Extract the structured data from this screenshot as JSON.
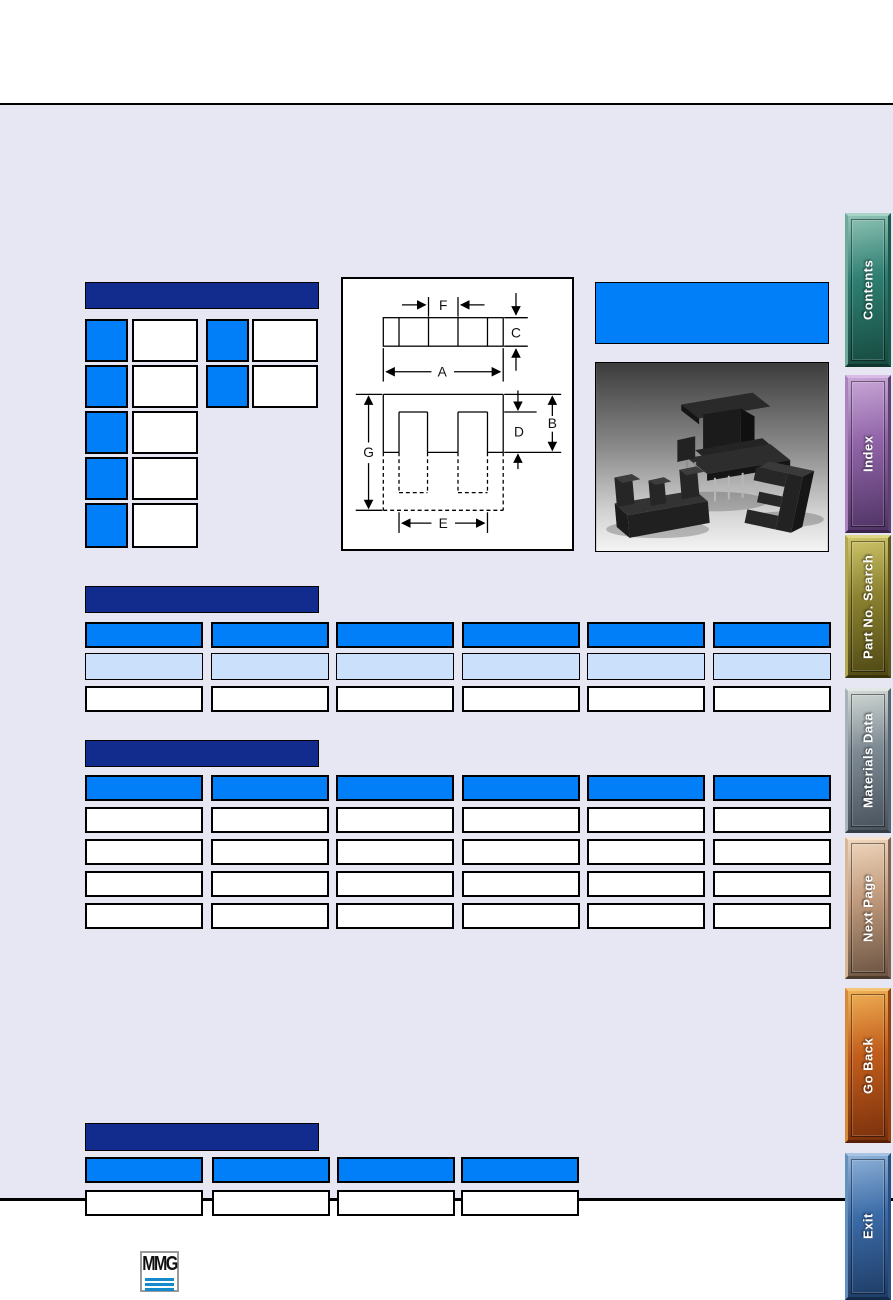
{
  "page": {
    "background_color": "#E7E7F3",
    "rule_color": "#000000"
  },
  "colors": {
    "section_header_bar": "#122C8E",
    "cell_blue": "#007FF8",
    "cell_light_blue": "#CBE0FA",
    "cell_white": "#FFFFFF",
    "product_box_blue": "#007FF8"
  },
  "sections": {
    "parameter_table": {
      "title": ""
    },
    "table_top": {
      "title": ""
    },
    "table_middle": {
      "title": ""
    },
    "table_bottom": {
      "title": ""
    }
  },
  "product_title_box": {
    "text": ""
  },
  "diagram": {
    "labels": {
      "a": "A",
      "b": "B",
      "c": "C",
      "d": "D",
      "e": "E",
      "f": "F",
      "g": "G"
    }
  },
  "photo": {
    "description": ""
  },
  "logo": {
    "text": "MMG"
  },
  "sidebar": {
    "buttons": [
      {
        "label": "Contents",
        "hi": "#8FC3B5",
        "base": "#2E7F72",
        "lo": "#174A40",
        "lt": "#A9D4C8",
        "lt2": "#6FA99B",
        "dk": "#0F352D",
        "dk2": "#1C574B"
      },
      {
        "label": "Index",
        "hi": "#C9A8D8",
        "base": "#9165A8",
        "lo": "#4F3364",
        "lt": "#D9BCE6",
        "lt2": "#AB82C0",
        "dk": "#3A2449",
        "dk2": "#5D3F72"
      },
      {
        "label": "Part No. Search",
        "hi": "#CFC66B",
        "base": "#8C8230",
        "lo": "#4F4814",
        "lt": "#DFD788",
        "lt2": "#B0A74E",
        "dk": "#39330C",
        "dk2": "#5E561E"
      },
      {
        "label": "Materials Data",
        "hi": "#D3DAD6",
        "base": "#7E8A94",
        "lo": "#47525C",
        "lt": "#E2E8E4",
        "lt2": "#A7B2B9",
        "dk": "#333D46",
        "dk2": "#57636D"
      },
      {
        "label": "Next Page",
        "hi": "#F0D7BE",
        "base": "#C29C7E",
        "lo": "#6B5442",
        "lt": "#F7E5D2",
        "lt2": "#D6B697",
        "dk": "#4B3A2D",
        "dk2": "#7E6450"
      },
      {
        "label": "Go Back",
        "hi": "#F0B055",
        "base": "#C25E1C",
        "lo": "#7A300C",
        "lt": "#F6C477",
        "lt2": "#D98A38",
        "dk": "#571F06",
        "dk2": "#93400F"
      },
      {
        "label": "Exit",
        "hi": "#8FB2D8",
        "base": "#3C6CA8",
        "lo": "#1E3C66",
        "lt": "#A9C4E2",
        "lt2": "#6490BE",
        "dk": "#142A49",
        "dk2": "#2A4E80"
      }
    ]
  }
}
